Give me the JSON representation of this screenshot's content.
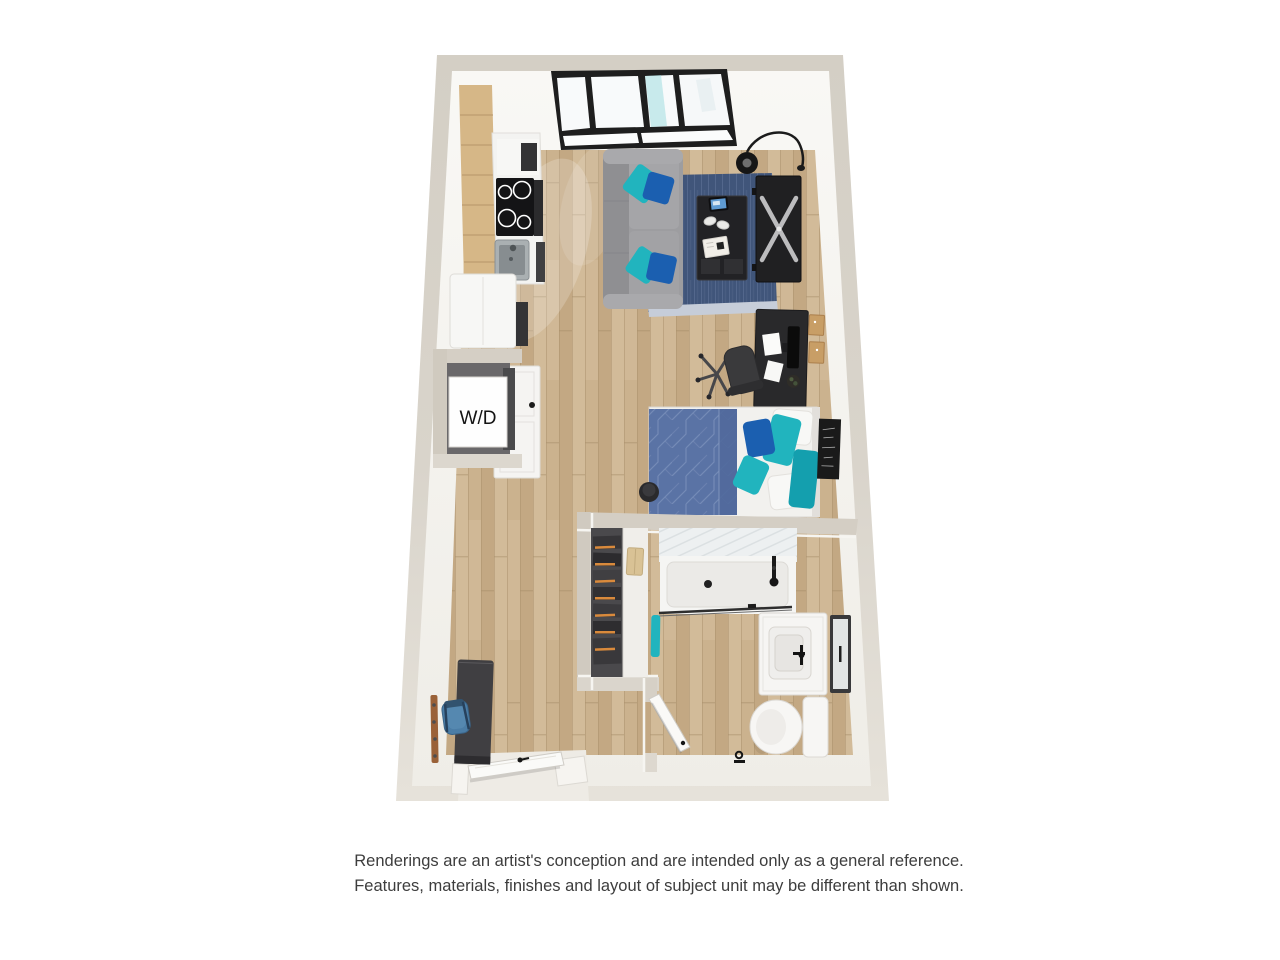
{
  "floorplan": {
    "washer_dryer_label": "W/D",
    "colors": {
      "wall": "#d5cfc5",
      "wall_light": "#e4e0d8",
      "wall_inner_face": "#f5f4f0",
      "floor_wood": "#cbb28e",
      "sofa_gray": "#9d9da0",
      "rug_navy": "#40557a",
      "duvet_blue": "#5a73a5",
      "accent_teal": "#21b4be",
      "accent_blue": "#1b5fb0",
      "furniture_black": "#232326",
      "cabinet_wood": "#d6b787"
    },
    "items": [
      "window",
      "kitchen-cabinets",
      "cooktop",
      "kitchen-sink",
      "refrigerator",
      "washer-dryer-closet",
      "sofa",
      "area-rug",
      "coffee-table",
      "tv-console",
      "arc-floor-lamp",
      "desk",
      "office-chair",
      "cork-boards",
      "bed",
      "wall-art",
      "nightstand-stool",
      "walk-in-closet",
      "shower",
      "bathroom-vanity",
      "mirror",
      "toilet",
      "towel",
      "entry-bench",
      "coat-rack",
      "backpack",
      "entry-door",
      "bathroom-door"
    ]
  },
  "disclaimer": {
    "line1": "Renderings are an artist's conception and are intended only as a general reference.",
    "line2": "Features, materials, finishes and layout of subject unit may be different than shown."
  }
}
